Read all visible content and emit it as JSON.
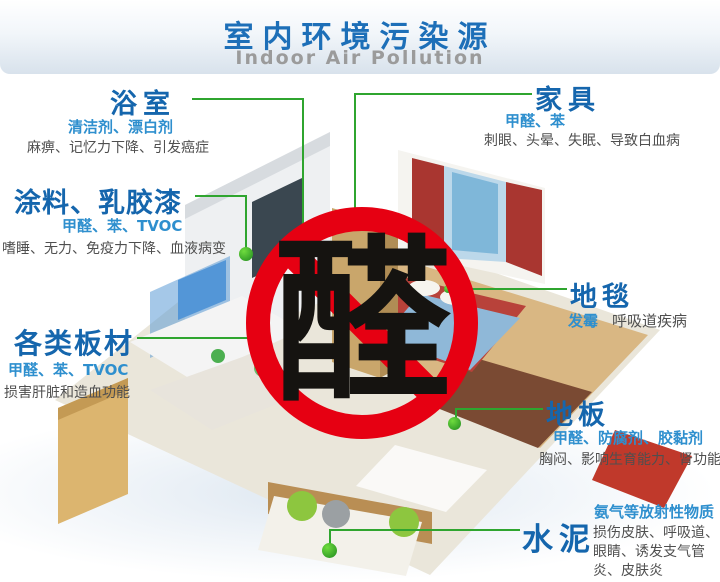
{
  "header": {
    "title": "室内环境污染源",
    "subtitle": "Indoor Air Pollution"
  },
  "sign": {
    "character": "醛"
  },
  "labels": {
    "bathroom": {
      "title": "浴室",
      "pollutants": "清洁剂、漂白剂",
      "effects": "麻痹、记忆力下降、引发癌症"
    },
    "paint": {
      "title": "涂料、乳胶漆",
      "pollutants": "甲醛、苯、TVOC",
      "effects": "嗜睡、无力、免疫力下降、血液病变"
    },
    "boards": {
      "title": "各类板材",
      "pollutants": "甲醛、苯、TVOC",
      "effects": "损害肝脏和造血功能"
    },
    "furniture": {
      "title": "家具",
      "pollutants": "甲醛、苯",
      "effects": "刺眼、头晕、失眠、导致白血病"
    },
    "carpet": {
      "title": "地毯",
      "pollutants": "发霉",
      "effects": "呼吸道疾病"
    },
    "floor": {
      "title": "地板",
      "pollutants": "甲醛、防腐剂、胶黏剂",
      "effects": "胸闷、影响生育能力、肾功能"
    },
    "cement": {
      "title": "水泥",
      "pollutants": "氨气等放射性物质",
      "effects": "损伤皮肤、呼吸道、眼睛、诱发支气管炎、皮肤炎"
    }
  },
  "colors": {
    "title_blue": "#1d6fb8",
    "label_blue": "#1566ad",
    "pollutant_blue": "#2e8fce",
    "effect_gray": "#4f4f4f",
    "line_green": "#2fa52f",
    "sign_red": "#e60012"
  }
}
